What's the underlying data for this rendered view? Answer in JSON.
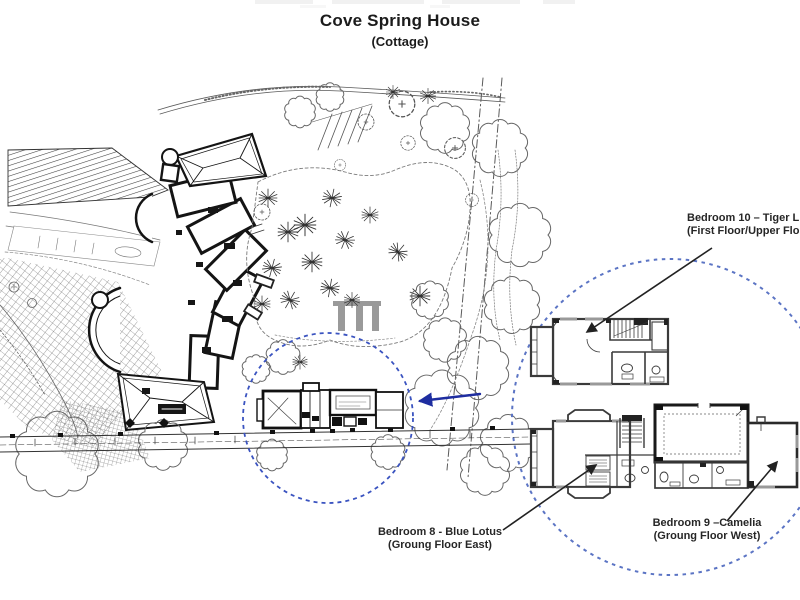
{
  "title": {
    "main": "Cove Spring House",
    "subtitle": "(Cottage)"
  },
  "annotations": {
    "bedroom10": {
      "line1": "Bedroom 10 – Tiger L",
      "line2": "(First Floor/Upper Flo"
    },
    "bedroom8": {
      "line1": "Bedroom 8 - Blue Lotus",
      "line2": "(Groung Floor East)"
    },
    "bedroom9": {
      "line1": "Bedroom 9 –Camelia",
      "line2": "(Groung Floor West)"
    }
  },
  "colors": {
    "small_circle_blue": "#3a53c0",
    "big_circle_blue": "#5b74c4",
    "arrow_blue": "#1e2da0",
    "ink": "#1f1f1f",
    "drawing_gray": "#555555"
  }
}
